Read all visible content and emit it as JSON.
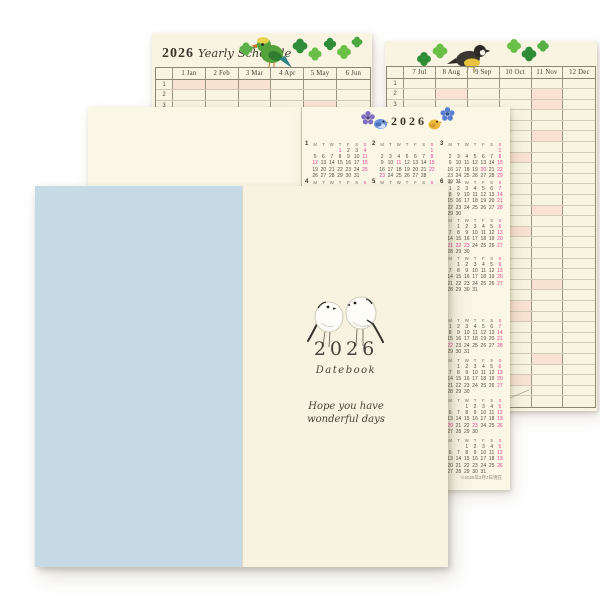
{
  "yearly_schedule": {
    "year": "2026",
    "title": "Yearly Schedule",
    "day_rows": 31,
    "highlight_color": "#f9e2d1",
    "left_page": {
      "month_columns": [
        "1 Jan",
        "2 Feb",
        "3 Mar",
        "4 Apr",
        "5 May",
        "6 Jun"
      ],
      "highlight_cells": [
        [
          1,
          0
        ],
        [
          1,
          1
        ],
        [
          1,
          2
        ],
        [
          3,
          4
        ]
      ]
    },
    "right_page": {
      "month_columns": [
        "7 Jul",
        "8 Aug",
        "9 Sep",
        "10 Oct",
        "11 Nov",
        "12 Dec"
      ],
      "highlight_cells": [
        [
          2,
          1
        ],
        [
          2,
          4
        ],
        [
          3,
          4
        ],
        [
          6,
          4
        ],
        [
          8,
          3
        ],
        [
          13,
          4
        ],
        [
          15,
          3
        ],
        [
          20,
          4
        ],
        [
          22,
          3
        ],
        [
          23,
          3
        ],
        [
          27,
          4
        ],
        [
          29,
          3
        ]
      ]
    }
  },
  "calendar_page": {
    "year_title": "2026",
    "weekday_header": [
      "M",
      "T",
      "W",
      "T",
      "F",
      "S",
      "S"
    ],
    "sunday_color": "#e83a92",
    "footnote": "※2025年2月3日現在",
    "blocks": [
      {
        "year": "2026",
        "months": [
          {
            "label": "1",
            "col": 0,
            "row": 0,
            "start": 3,
            "days": 31,
            "pink": [
              1,
              4,
              11,
              12,
              18,
              25
            ]
          },
          {
            "label": "2",
            "col": 1,
            "row": 0,
            "start": 6,
            "days": 28,
            "pink": [
              1,
              8,
              11,
              15,
              22,
              23
            ]
          },
          {
            "label": "3",
            "col": 2,
            "row": 0,
            "start": 6,
            "days": 31,
            "pink": [
              1,
              8,
              15,
              20,
              22,
              29
            ]
          },
          {
            "label": "4",
            "col": 0,
            "row": 1,
            "start": 2,
            "days": 30,
            "pink": [
              5,
              12,
              19,
              26,
              29
            ]
          },
          {
            "label": "5",
            "col": 1,
            "row": 1,
            "start": 4,
            "days": 31,
            "pink": [
              3,
              4,
              5,
              6,
              10,
              17,
              24,
              31
            ]
          },
          {
            "label": "6",
            "col": 2,
            "row": 1,
            "start": 0,
            "days": 30,
            "pink": [
              7,
              14,
              21,
              28
            ]
          },
          {
            "label": "9",
            "col": 2,
            "row": 2,
            "start": 1,
            "days": 30,
            "pink": [
              6,
              13,
              20,
              21,
              22,
              23,
              27
            ]
          },
          {
            "label": "12",
            "col": 2,
            "row": 3,
            "start": 1,
            "days": 31,
            "pink": [
              6,
              13,
              20,
              27
            ]
          }
        ]
      },
      {
        "year": "2027",
        "months": [
          {
            "label": "3",
            "col": 2,
            "row": 0,
            "start": 0,
            "days": 31,
            "pink": [
              7,
              14,
              21,
              22,
              28
            ]
          },
          {
            "label": "6",
            "col": 2,
            "row": 1,
            "start": 1,
            "days": 30,
            "pink": [
              6,
              13,
              20,
              27
            ]
          },
          {
            "label": "9",
            "col": 2,
            "row": 2,
            "start": 2,
            "days": 30,
            "pink": [
              5,
              12,
              19,
              20,
              23,
              26
            ]
          },
          {
            "label": "12",
            "col": 2,
            "row": 3,
            "start": 2,
            "days": 31,
            "pink": [
              5,
              12,
              19,
              26
            ]
          }
        ]
      }
    ]
  },
  "cover": {
    "year": "2026",
    "subtitle": "Datebook",
    "message": [
      "Hope you have",
      "wonderful days"
    ],
    "left_panel_color": "#c6dae6",
    "right_panel_color": "#f7f3e0"
  },
  "decorations": {
    "yearly_left": "green-parrot-with-clovers",
    "yearly_right": "yellow-black-bird-with-clovers",
    "calendar_title": "flowers-and-two-small-birds",
    "cover": "two-white-long-tailed-birds"
  }
}
